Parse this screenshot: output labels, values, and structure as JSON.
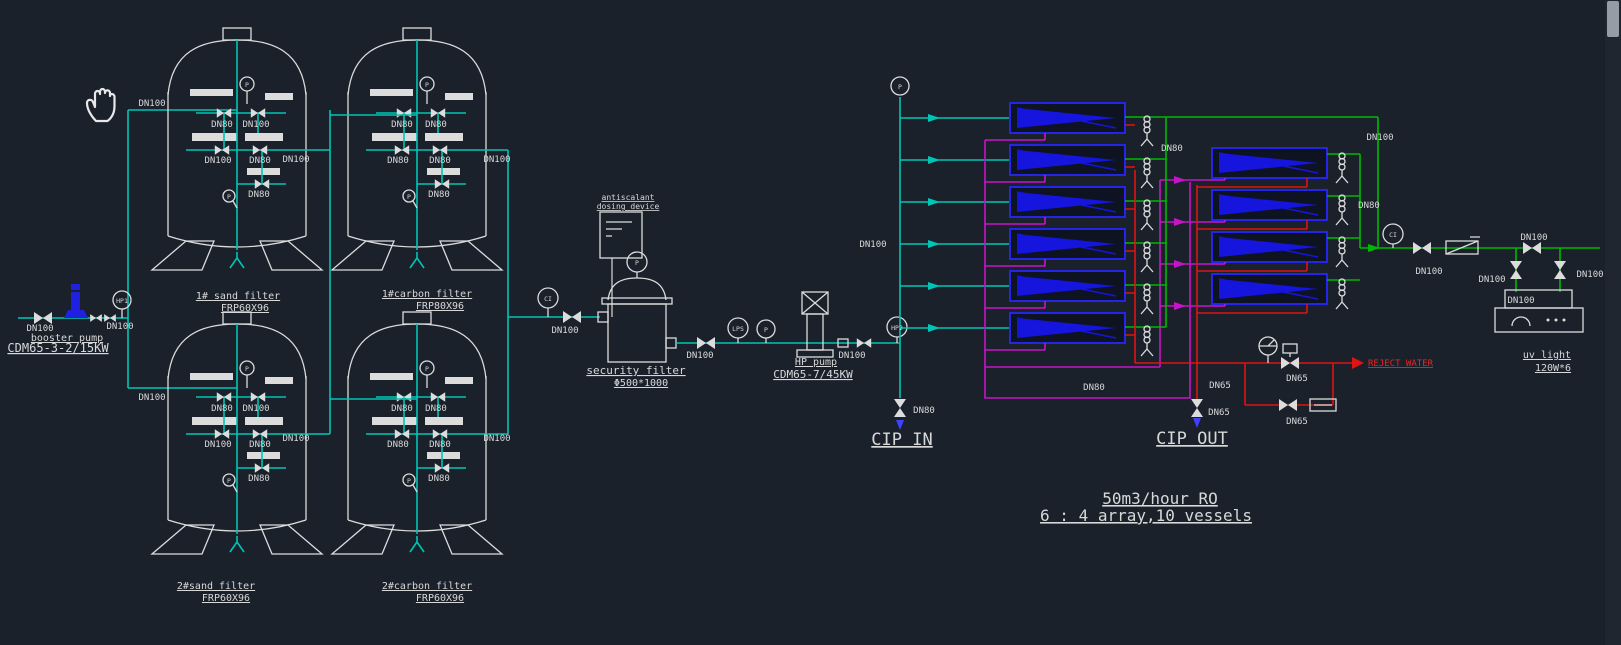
{
  "canvas": {
    "background": "#1a212b"
  },
  "colors": {
    "feed_water": "#00c5b5",
    "permeate": "#00b800",
    "cip": "#c814c8",
    "concentrate": "#de1414",
    "membrane": "#2525e8",
    "linework": "#dcdcdc",
    "alert_text": "#ee2222"
  },
  "pipe": {
    "dn100": "DN100",
    "dn80": "DN80",
    "dn65": "DN65"
  },
  "instruments": {
    "p": "P",
    "hp1": "HP1",
    "hp2": "HP2",
    "lps": "LPS",
    "ci": "CI"
  },
  "equipment": {
    "booster_pump": {
      "label": "booster pump",
      "model": "CDM65-3-2/15KW"
    },
    "hp_pump": {
      "label": "HP pump",
      "model": "CDM65-7/45KW"
    },
    "security_filter": {
      "label": "security filter",
      "model": "Φ500*1000"
    },
    "dosing_device": {
      "line1": "antiscalant",
      "line2": "dosing device"
    },
    "uv_light": {
      "label": "uv light",
      "model": "120W*6"
    },
    "tanks": [
      {
        "label": "1# sand filter",
        "model": "FRP60X96"
      },
      {
        "label": "1#carbon filter",
        "model": "FRP80X96"
      },
      {
        "label": "2#sand filter",
        "model": "FRP60X96"
      },
      {
        "label": "2#carbon filter",
        "model": "FRP60X96"
      }
    ]
  },
  "annotations": {
    "cip_in": "CIP IN",
    "cip_out": "CIP OUT",
    "reject": "REJECT WATER",
    "title1": "50m3/hour RO",
    "title2": "6 : 4 array,10 vessels"
  },
  "array_info": {
    "stage1_vessels": 6,
    "stage2_vessels": 4
  }
}
